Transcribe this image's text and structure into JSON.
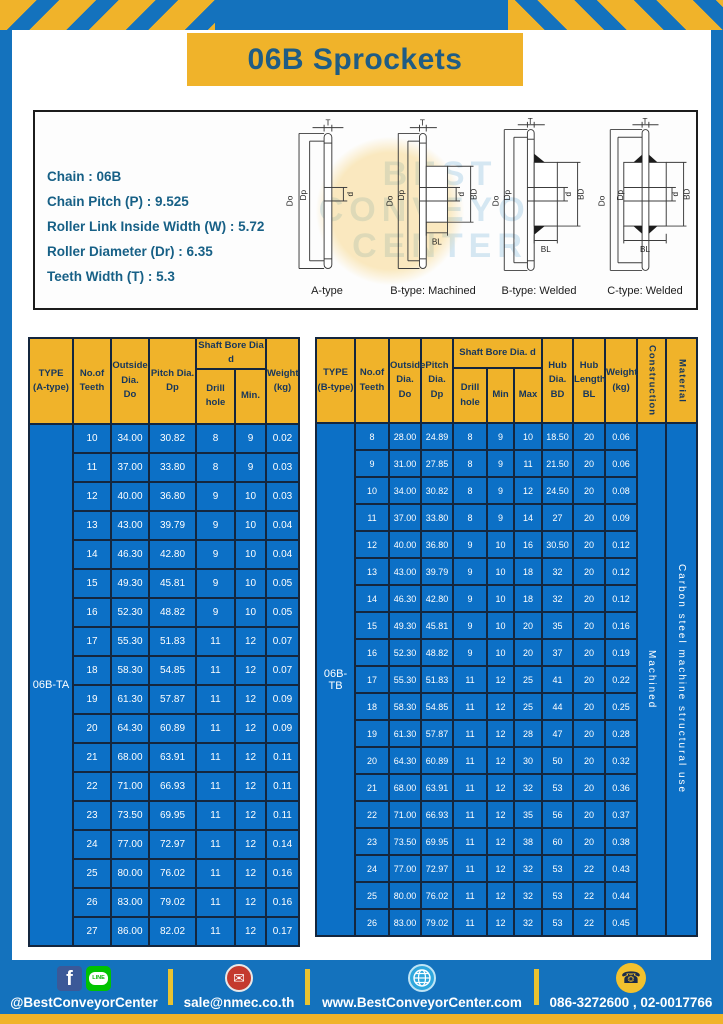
{
  "title": "06B Sprockets",
  "specs": {
    "lines": [
      "Chain : 06B",
      "Chain Pitch (P) : 9.525",
      "Roller Link Inside Width (W) : 5.72",
      "Roller Diameter (Dr) : 6.35",
      "Teeth Width (T) : 5.3"
    ],
    "watermark": [
      "BEST",
      "CONVEYOR",
      "CENTER"
    ]
  },
  "diagrams": {
    "captions": [
      "A-type",
      "B-type: Machined",
      "B-type: Welded",
      "C-type: Welded"
    ],
    "dims": {
      "t": "T",
      "outer": "Do",
      "pitch": "Dp",
      "bore": "d",
      "hub_dia": "BD",
      "hub_len": "BL"
    }
  },
  "table_a": {
    "type_label": "06B-TA",
    "headers": {
      "type": "TYPE\n(A-type)",
      "teeth": "No.of\nTeeth",
      "outside": "Outside\nDia.\nDo",
      "pitch": "Pitch Dia.\nDp",
      "shaft_bore": "Shaft Bore Dia d",
      "drill": "Drill hole",
      "min": "Min.",
      "weight": "Weight\n(kg)"
    },
    "rows": [
      [
        "10",
        "34.00",
        "30.82",
        "8",
        "9",
        "0.02"
      ],
      [
        "11",
        "37.00",
        "33.80",
        "8",
        "9",
        "0.03"
      ],
      [
        "12",
        "40.00",
        "36.80",
        "9",
        "10",
        "0.03"
      ],
      [
        "13",
        "43.00",
        "39.79",
        "9",
        "10",
        "0.04"
      ],
      [
        "14",
        "46.30",
        "42.80",
        "9",
        "10",
        "0.04"
      ],
      [
        "15",
        "49.30",
        "45.81",
        "9",
        "10",
        "0.05"
      ],
      [
        "16",
        "52.30",
        "48.82",
        "9",
        "10",
        "0.05"
      ],
      [
        "17",
        "55.30",
        "51.83",
        "11",
        "12",
        "0.07"
      ],
      [
        "18",
        "58.30",
        "54.85",
        "11",
        "12",
        "0.07"
      ],
      [
        "19",
        "61.30",
        "57.87",
        "11",
        "12",
        "0.09"
      ],
      [
        "20",
        "64.30",
        "60.89",
        "11",
        "12",
        "0.09"
      ],
      [
        "21",
        "68.00",
        "63.91",
        "11",
        "12",
        "0.11"
      ],
      [
        "22",
        "71.00",
        "66.93",
        "11",
        "12",
        "0.11"
      ],
      [
        "23",
        "73.50",
        "69.95",
        "11",
        "12",
        "0.11"
      ],
      [
        "24",
        "77.00",
        "72.97",
        "11",
        "12",
        "0.14"
      ],
      [
        "25",
        "80.00",
        "76.02",
        "11",
        "12",
        "0.16"
      ],
      [
        "26",
        "83.00",
        "79.02",
        "11",
        "12",
        "0.16"
      ],
      [
        "27",
        "86.00",
        "82.02",
        "11",
        "12",
        "0.17"
      ]
    ]
  },
  "table_b": {
    "type_label": "06B-TB",
    "construction": "Machined",
    "material": "Carbon steel machine structural use",
    "headers": {
      "type": "TYPE\n(B-type)",
      "teeth": "No.of\nTeeth",
      "outside": "Outside\nDia.\nDo",
      "pitch": "Pitch\nDia.\nDp",
      "shaft_bore": "Shaft Bore Dia. d",
      "drill": "Drill hole",
      "min": "Min",
      "max": "Max",
      "hub_dia": "Hub\nDia.\nBD",
      "hub_len": "Hub\nLength\nBL",
      "weight": "Weight\n(kg)",
      "construction": "Construction",
      "material": "Material"
    },
    "rows": [
      [
        "8",
        "28.00",
        "24.89",
        "8",
        "9",
        "10",
        "18.50",
        "20",
        "0.06"
      ],
      [
        "9",
        "31.00",
        "27.85",
        "8",
        "9",
        "11",
        "21.50",
        "20",
        "0.06"
      ],
      [
        "10",
        "34.00",
        "30.82",
        "8",
        "9",
        "12",
        "24.50",
        "20",
        "0.08"
      ],
      [
        "11",
        "37.00",
        "33.80",
        "8",
        "9",
        "14",
        "27",
        "20",
        "0.09"
      ],
      [
        "12",
        "40.00",
        "36.80",
        "9",
        "10",
        "16",
        "30.50",
        "20",
        "0.12"
      ],
      [
        "13",
        "43.00",
        "39.79",
        "9",
        "10",
        "18",
        "32",
        "20",
        "0.12"
      ],
      [
        "14",
        "46.30",
        "42.80",
        "9",
        "10",
        "18",
        "32",
        "20",
        "0.12"
      ],
      [
        "15",
        "49.30",
        "45.81",
        "9",
        "10",
        "20",
        "35",
        "20",
        "0.16"
      ],
      [
        "16",
        "52.30",
        "48.82",
        "9",
        "10",
        "20",
        "37",
        "20",
        "0.19"
      ],
      [
        "17",
        "55.30",
        "51.83",
        "11",
        "12",
        "25",
        "41",
        "20",
        "0.22"
      ],
      [
        "18",
        "58.30",
        "54.85",
        "11",
        "12",
        "25",
        "44",
        "20",
        "0.25"
      ],
      [
        "19",
        "61.30",
        "57.87",
        "11",
        "12",
        "28",
        "47",
        "20",
        "0.28"
      ],
      [
        "20",
        "64.30",
        "60.89",
        "11",
        "12",
        "30",
        "50",
        "20",
        "0.32"
      ],
      [
        "21",
        "68.00",
        "63.91",
        "11",
        "12",
        "32",
        "53",
        "20",
        "0.36"
      ],
      [
        "22",
        "71.00",
        "66.93",
        "11",
        "12",
        "35",
        "56",
        "20",
        "0.37"
      ],
      [
        "23",
        "73.50",
        "69.95",
        "11",
        "12",
        "38",
        "60",
        "20",
        "0.38"
      ],
      [
        "24",
        "77.00",
        "72.97",
        "11",
        "12",
        "32",
        "53",
        "22",
        "0.43"
      ],
      [
        "25",
        "80.00",
        "76.02",
        "11",
        "12",
        "32",
        "53",
        "22",
        "0.44"
      ],
      [
        "26",
        "83.00",
        "79.02",
        "11",
        "12",
        "32",
        "53",
        "22",
        "0.45"
      ]
    ]
  },
  "footer": {
    "facebook_letter": "f",
    "line_text": "LINE",
    "mail_glyph": "✉",
    "phone_glyph": "☎",
    "social_label": "@BestConveyorCenter",
    "email": "sale@nmec.co.th",
    "website": "www.BestConveyorCenter.com",
    "phones": "086-3272600 , 02-0017766"
  },
  "colors": {
    "brand_blue": "#1472bd",
    "brand_yellow": "#f0b32a",
    "table_cell_blue": "#0c70c6",
    "table_border_navy": "#14263e",
    "title_text": "#1f5c84"
  }
}
